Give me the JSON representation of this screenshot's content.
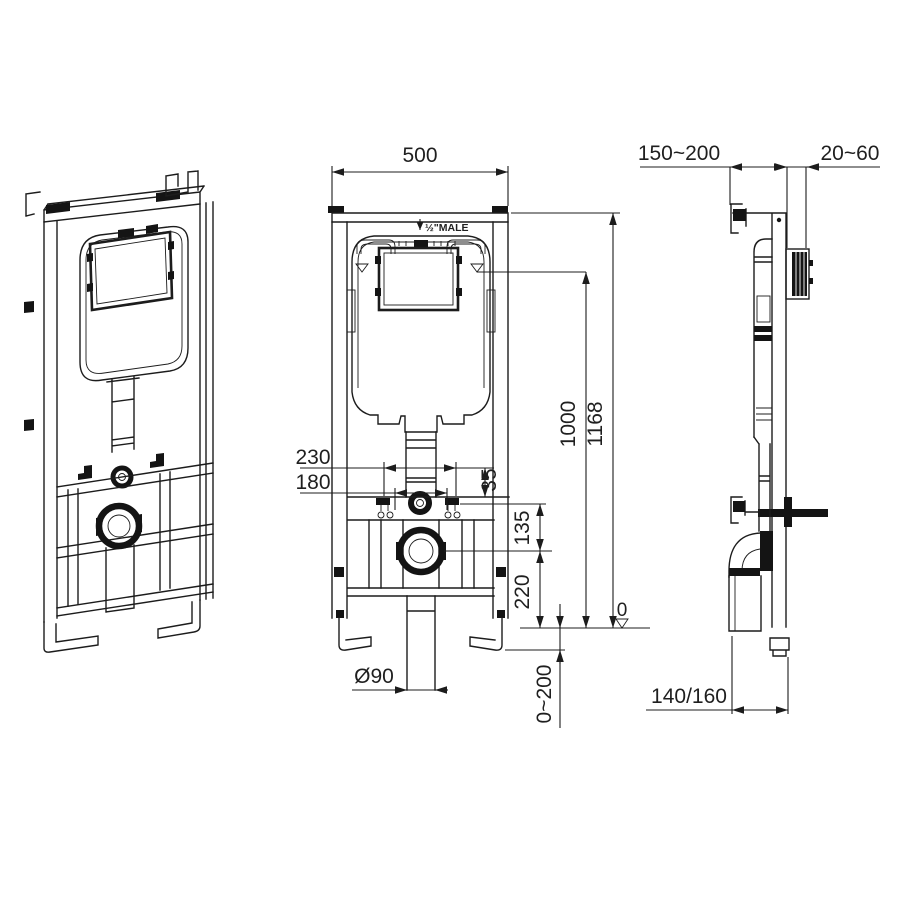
{
  "dims": {
    "front_width": "500",
    "inlet": "½\"MALE",
    "rod_spacing_outer": "230",
    "rod_spacing_inner": "180",
    "rod_offset": "35",
    "bolt_to_drain": "135",
    "drain_height": "220",
    "water_level": "1000",
    "frame_height": "1168",
    "floor_level": "0",
    "drain_pipe_dia": "Ø90",
    "foot_adjust": "0~200",
    "wall_distance": "150~200",
    "plate_depth": "20~60",
    "frame_depth": "140/160"
  }
}
